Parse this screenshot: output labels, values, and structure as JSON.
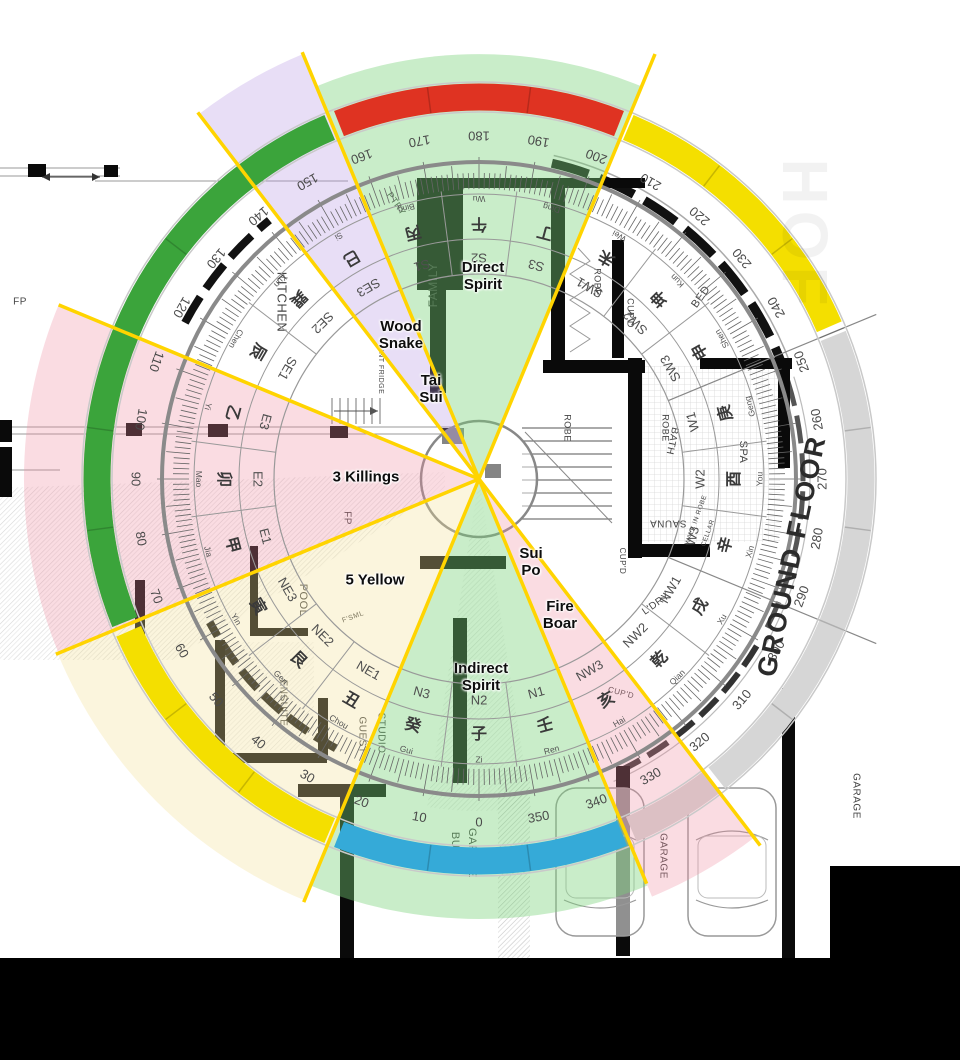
{
  "annotations": {
    "direct_spirit": {
      "text": "Direct\nSpirit",
      "x": 483,
      "y": 276
    },
    "wood_snake": {
      "text": "Wood\nSnake",
      "x": 401,
      "y": 335
    },
    "tai_sui": {
      "text": "Tai\nSui",
      "x": 431,
      "y": 389
    },
    "three_killings": {
      "text": "3 Killings",
      "x": 366,
      "y": 477
    },
    "five_yellow": {
      "text": "5 Yellow",
      "x": 375,
      "y": 580
    },
    "sui_po": {
      "text": "Sui\nPo",
      "x": 531,
      "y": 562
    },
    "fire_boar": {
      "text": "Fire\nBoar",
      "x": 560,
      "y": 615
    },
    "indirect_spirit": {
      "text": "Indirect\nSpirit",
      "x": 481,
      "y": 677
    }
  },
  "plan": {
    "ground_floor_label": "GROUND FLOOR",
    "watermark": "HOF",
    "rooms": [
      {
        "label": "KITCHEN",
        "x": 281,
        "y": 302,
        "rot": 90,
        "size": 13
      },
      {
        "label": "PTRY",
        "x": 396,
        "y": 204,
        "rot": 55,
        "size": 9
      },
      {
        "label": "INT FRIDGE",
        "x": 381,
        "y": 372,
        "rot": 90,
        "size": 7
      },
      {
        "label": "FAMILY",
        "x": 434,
        "y": 285,
        "rot": -90,
        "size": 12
      },
      {
        "label": "ROBE",
        "x": 597,
        "y": 282,
        "rot": 90,
        "size": 9
      },
      {
        "label": "CUP'D",
        "x": 630,
        "y": 313,
        "rot": 90,
        "size": 9
      },
      {
        "label": "BED",
        "x": 701,
        "y": 297,
        "rot": -55,
        "size": 11
      },
      {
        "label": "ROBE",
        "x": 567,
        "y": 428,
        "rot": 90,
        "size": 9
      },
      {
        "label": "ROBE",
        "x": 665,
        "y": 428,
        "rot": 90,
        "size": 9
      },
      {
        "label": "WALK IN ROBE",
        "x": 696,
        "y": 520,
        "rot": -70,
        "size": 6.5
      },
      {
        "label": "CELLAR",
        "x": 708,
        "y": 533,
        "rot": -70,
        "size": 6.5
      },
      {
        "label": "BATH",
        "x": 672,
        "y": 441,
        "rot": 102,
        "size": 10
      },
      {
        "label": "SPA",
        "x": 743,
        "y": 452,
        "rot": 90,
        "size": 11
      },
      {
        "label": "SAUNA",
        "x": 668,
        "y": 523,
        "rot": 180,
        "size": 10
      },
      {
        "label": "CUP'D",
        "x": 622,
        "y": 561,
        "rot": 90,
        "size": 8
      },
      {
        "label": "L'DRY",
        "x": 656,
        "y": 604,
        "rot": -35,
        "size": 10
      },
      {
        "label": "CUP'D",
        "x": 621,
        "y": 693,
        "rot": 15,
        "size": 8
      },
      {
        "label": "POOL",
        "x": 303,
        "y": 600,
        "rot": 90,
        "size": 11
      },
      {
        "label": "F'SML",
        "x": 353,
        "y": 617,
        "rot": -20,
        "size": 7
      },
      {
        "label": "ENSUITE",
        "x": 283,
        "y": 703,
        "rot": 90,
        "size": 10
      },
      {
        "label": "GUEST",
        "x": 362,
        "y": 735,
        "rot": 90,
        "size": 10
      },
      {
        "label": "STUDIO",
        "x": 381,
        "y": 733,
        "rot": 90,
        "size": 10
      },
      {
        "label": "BUGGY",
        "x": 455,
        "y": 853,
        "rot": 90,
        "size": 11
      },
      {
        "label": "GARAGE",
        "x": 472,
        "y": 853,
        "rot": 90,
        "size": 11
      },
      {
        "label": "GARAGE",
        "x": 663,
        "y": 856,
        "rot": 90,
        "size": 10
      },
      {
        "label": "GARAGE",
        "x": 856,
        "y": 796,
        "rot": 90,
        "size": 10
      },
      {
        "label": "FP",
        "x": 20,
        "y": 302,
        "rot": 0,
        "size": 10
      },
      {
        "label": "FP",
        "x": 347,
        "y": 518,
        "rot": 90,
        "size": 10
      }
    ]
  },
  "compass": {
    "center": {
      "x": 479,
      "y": 479
    },
    "degree_labels": [
      0,
      10,
      20,
      30,
      40,
      50,
      60,
      70,
      80,
      90,
      100,
      110,
      120,
      130,
      140,
      150,
      160,
      170,
      180,
      190,
      200,
      210,
      220,
      230,
      240,
      250,
      260,
      270,
      280,
      290,
      300,
      310,
      320,
      330,
      340,
      350
    ],
    "mountains": [
      {
        "ch": "丙",
        "pinyin": "Bing",
        "bearing": 165
      },
      {
        "ch": "午",
        "pinyin": "Wu",
        "bearing": 180
      },
      {
        "ch": "丁",
        "pinyin": "Ding",
        "bearing": 195
      },
      {
        "ch": "未",
        "pinyin": "Wei",
        "bearing": 210
      },
      {
        "ch": "坤",
        "pinyin": "Kun",
        "bearing": 225
      },
      {
        "ch": "申",
        "pinyin": "Shen",
        "bearing": 240
      },
      {
        "ch": "庚",
        "pinyin": "Geng",
        "bearing": 255
      },
      {
        "ch": "酉",
        "pinyin": "You",
        "bearing": 270
      },
      {
        "ch": "辛",
        "pinyin": "Xin",
        "bearing": 285
      },
      {
        "ch": "戌",
        "pinyin": "Xu",
        "bearing": 300
      },
      {
        "ch": "乾",
        "pinyin": "Qian",
        "bearing": 315
      },
      {
        "ch": "亥",
        "pinyin": "Hai",
        "bearing": 330
      },
      {
        "ch": "壬",
        "pinyin": "Ren",
        "bearing": 345
      },
      {
        "ch": "子",
        "pinyin": "Zi",
        "bearing": 0
      },
      {
        "ch": "癸",
        "pinyin": "Gui",
        "bearing": 15
      },
      {
        "ch": "丑",
        "pinyin": "Chou",
        "bearing": 30
      },
      {
        "ch": "艮",
        "pinyin": "Gen",
        "bearing": 45
      },
      {
        "ch": "寅",
        "pinyin": "Yin",
        "bearing": 60
      },
      {
        "ch": "甲",
        "pinyin": "Jia",
        "bearing": 75
      },
      {
        "ch": "卯",
        "pinyin": "Mao",
        "bearing": 90
      },
      {
        "ch": "乙",
        "pinyin": "Yi",
        "bearing": 105
      },
      {
        "ch": "辰",
        "pinyin": "Chen",
        "bearing": 120
      },
      {
        "ch": "巽",
        "pinyin": "Xun",
        "bearing": 135
      },
      {
        "ch": "巳",
        "pinyin": "Si",
        "bearing": 150
      }
    ],
    "ring_sectors": [
      {
        "label": "S1",
        "bearing": 165
      },
      {
        "label": "S2",
        "bearing": 180
      },
      {
        "label": "S3",
        "bearing": 195
      },
      {
        "label": "SW1",
        "bearing": 210
      },
      {
        "label": "SW2",
        "bearing": 225
      },
      {
        "label": "SW3",
        "bearing": 240
      },
      {
        "label": "W1",
        "bearing": 255
      },
      {
        "label": "W2",
        "bearing": 270
      },
      {
        "label": "W3",
        "bearing": 285
      },
      {
        "label": "NW1",
        "bearing": 300
      },
      {
        "label": "NW2",
        "bearing": 315
      },
      {
        "label": "NW3",
        "bearing": 330
      },
      {
        "label": "N1",
        "bearing": 345
      },
      {
        "label": "N2",
        "bearing": 0
      },
      {
        "label": "N3",
        "bearing": 15
      },
      {
        "label": "NE1",
        "bearing": 30
      },
      {
        "label": "NE2",
        "bearing": 45
      },
      {
        "label": "NE3",
        "bearing": 60
      },
      {
        "label": "E1",
        "bearing": 75
      },
      {
        "label": "E2",
        "bearing": 90
      },
      {
        "label": "E3",
        "bearing": 105
      },
      {
        "label": "SE1",
        "bearing": 120
      },
      {
        "label": "SE2",
        "bearing": 135
      },
      {
        "label": "SE3",
        "bearing": 150
      }
    ],
    "bands": [
      {
        "name": "south-red",
        "color": "#df3322",
        "from": 158.5,
        "to": 201.5
      },
      {
        "name": "southwest-yellow",
        "color": "#f4df00",
        "from": 203,
        "to": 246.5
      },
      {
        "name": "west-gray",
        "color": "#d6d6d6",
        "from": 248,
        "to": 321.5
      },
      {
        "name": "northwest-gray-pink",
        "color": "#dcc0c4",
        "from": 322.5,
        "to": 336.5
      },
      {
        "name": "north-blue",
        "color": "#35aad8",
        "from": 338,
        "to": 381.5
      },
      {
        "name": "northeast-yellow",
        "color": "#f4df00",
        "from": 23,
        "to": 66.5
      },
      {
        "name": "east-green",
        "color": "#3ba43b",
        "from": 68,
        "to": 157
      },
      {
        "name": "hidden-note",
        "color": "",
        "from": 0,
        "to": 0
      }
    ],
    "sector_fills": [
      {
        "name": "direct-spirit-south",
        "color": "rgba(120,210,120,0.40)",
        "from": 157.5,
        "to": 202.5,
        "r": 425
      },
      {
        "name": "tai-sui-lavender",
        "color": "rgba(182,152,228,0.32)",
        "from": 142.5,
        "to": 157.5,
        "r": 460
      },
      {
        "name": "three-killings-pink",
        "color": "rgba(238,140,160,0.30)",
        "from": 67.5,
        "to": 112.5,
        "r": 455
      },
      {
        "name": "five-yellow-cream",
        "color": "rgba(242,224,150,0.32)",
        "from": 22.5,
        "to": 67.5,
        "r": 456
      },
      {
        "name": "indirect-spirit-north",
        "color": "rgba(120,210,120,0.40)",
        "from": 337.5,
        "to": 382.5,
        "r": 440
      },
      {
        "name": "sui-po-pink",
        "color": "rgba(238,140,160,0.30)",
        "from": 322.5,
        "to": 337.5,
        "r": 452
      }
    ],
    "yellow_line_bearings": [
      22.5,
      67.5,
      112.5,
      142.5,
      157.5,
      202.5,
      322.5,
      337.5
    ],
    "yellow_line_color": "#ffd400"
  },
  "colors": {
    "wall": "#0a0a0a",
    "plan_line": "#999999",
    "ring_line": "#8a8a8a",
    "degree_text": "#4a4a4a",
    "mountain_text": "#3a3a3a",
    "sector_text": "#4f4f4f",
    "room_text": "#444444"
  }
}
